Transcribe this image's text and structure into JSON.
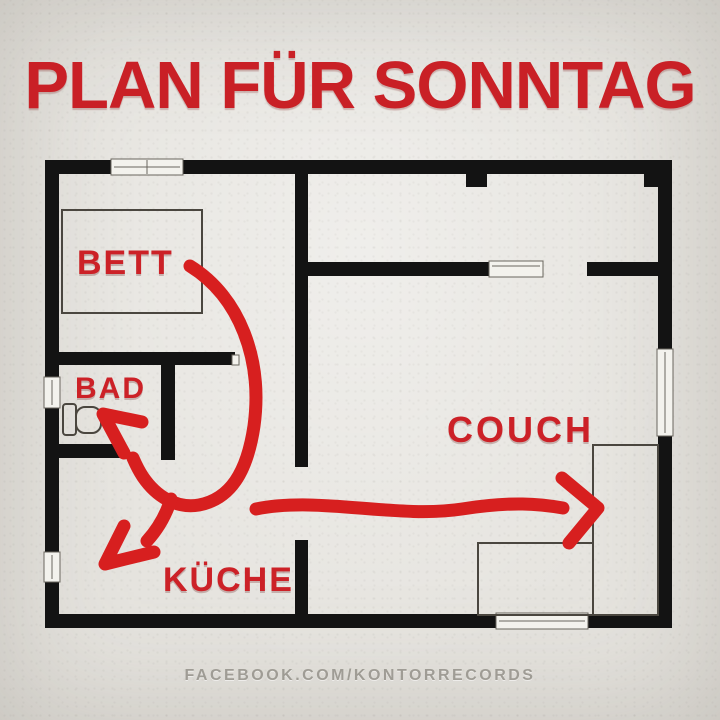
{
  "title": "PLAN FÜR SONNTAG",
  "watermark": "FACEBOOK.COM/KONTORRECORDS",
  "floorplan": {
    "rooms": [
      {
        "id": "bett",
        "label": "BETT"
      },
      {
        "id": "bad",
        "label": "BAD"
      },
      {
        "id": "kueche",
        "label": "KÜCHE"
      },
      {
        "id": "couch",
        "label": "COUCH"
      }
    ],
    "route": [
      "BETT",
      "BAD",
      "KÜCHE",
      "COUCH"
    ]
  },
  "icons": {
    "bed": "bed-outline-icon",
    "toilet": "toilet-icon",
    "couch": "couch-outline-icon",
    "window": "window-icon",
    "route_arrow": "route-arrow-icon"
  },
  "colors": {
    "background": "#e6e4df",
    "wall": "#131313",
    "furniture_outline": "#4a463f",
    "title_red": "#c92026",
    "label_red": "#cc2127",
    "arrow_red": "#d71f1f",
    "watermark": "#95928a"
  }
}
